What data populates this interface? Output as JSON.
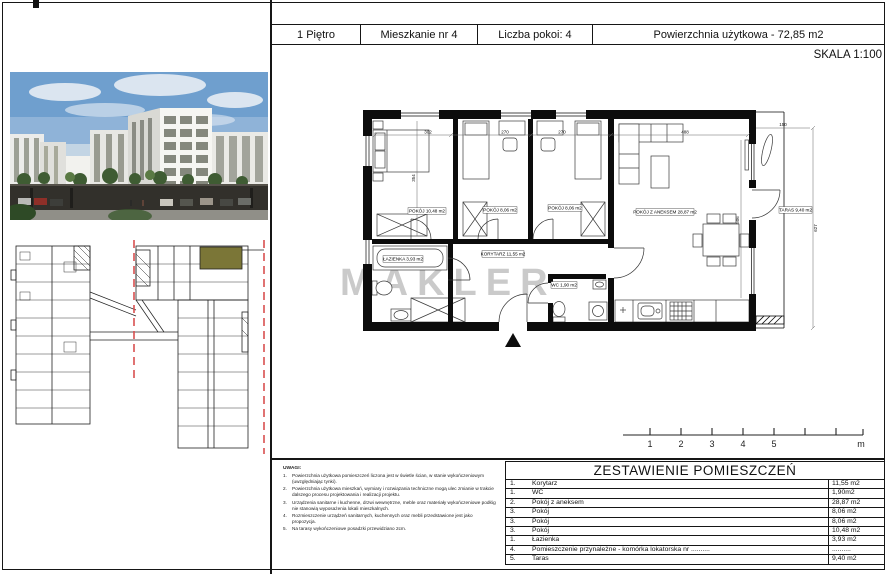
{
  "header": {
    "floor": "1 Piętro",
    "apartment": "Mieszkanie nr 4",
    "rooms_count": "Liczba pokoi: 4",
    "usable_area": "Powierzchnia użytkowa - 72,85 m2",
    "scale": "SKALA 1:100"
  },
  "watermark": "MAKLER",
  "colors": {
    "highlight_unit": "#7b7637",
    "section_dash": "#d95050",
    "watermark_gray": "#bdbdbd"
  },
  "plan": {
    "labels": {
      "room1": "POKÓJ 10,48 m2",
      "room2": "POKÓJ 8,06 m2",
      "room3": "POKÓJ 8,06 m2",
      "living": "POKÓJ Z ANEKSEM 28,87 m2",
      "corridor": "KORYTARZ 11,55 m2",
      "bath": "ŁAZIENKA 3,93 m2",
      "wc": "WC 1,90 m2",
      "taras": "TARAS 9,40 m2"
    },
    "dims": [
      "302",
      "270",
      "270",
      "488",
      "354",
      "506",
      "150",
      "627"
    ]
  },
  "scalebar": {
    "labels": [
      "1",
      "2",
      "3",
      "4",
      "5"
    ],
    "unit": "m"
  },
  "summary": {
    "title": "ZESTAWIENIE POMIESZCZEŃ",
    "rows": [
      {
        "no": "1.",
        "name": "Korytarz",
        "area": "11,55 m2"
      },
      {
        "no": "1.",
        "name": "WC",
        "area": "1,90m2"
      },
      {
        "no": "2.",
        "name": "Pokój z aneksem",
        "area": "28,87 m2"
      },
      {
        "no": "3.",
        "name": "Pokój",
        "area": "8,06 m2"
      },
      {
        "no": "3.",
        "name": "Pokój",
        "area": "8,06 m2"
      },
      {
        "no": "3.",
        "name": "Pokój",
        "area": "10,48 m2"
      },
      {
        "no": "1.",
        "name": "Łazienka",
        "area": "3,93 m2"
      },
      {
        "no": "4.",
        "name": "Pomieszczenie przynależne - komórka lokatorska nr ..........",
        "area": ".........."
      },
      {
        "no": "5.",
        "name": "Taras",
        "area": "9,40 m2"
      }
    ]
  },
  "notes": {
    "title": "UWAGI:",
    "items": [
      {
        "no": "1.",
        "text": "Powierzchnia użytkowa pomieszczeń liczona jest w świetle ścian, w stanie wykończeniowym (uwzględniając tynki)."
      },
      {
        "no": "2.",
        "text": "Powierzchnia użytkowa mieszkań, wymiary i rozwiązania techniczne mogą ulec zmianie w trakcie dalszego procesu projektowania i realizacji projektu."
      },
      {
        "no": "3.",
        "text": "Urządzenia sanitarne i kuchenne, drzwi wewnętrzne, meble oraz materiały wykończeniowe podłóg nie stanowią wyposażenia lokali mieszkalnych."
      },
      {
        "no": "4.",
        "text": "Rozmieszczenie urządzeń sanitarnych, kuchennych oraz mebli przedstawione jest jako propozycja."
      },
      {
        "no": "5.",
        "text": "Na tarasy wykończeniowe posadzki przewidziano 2cm."
      }
    ]
  }
}
